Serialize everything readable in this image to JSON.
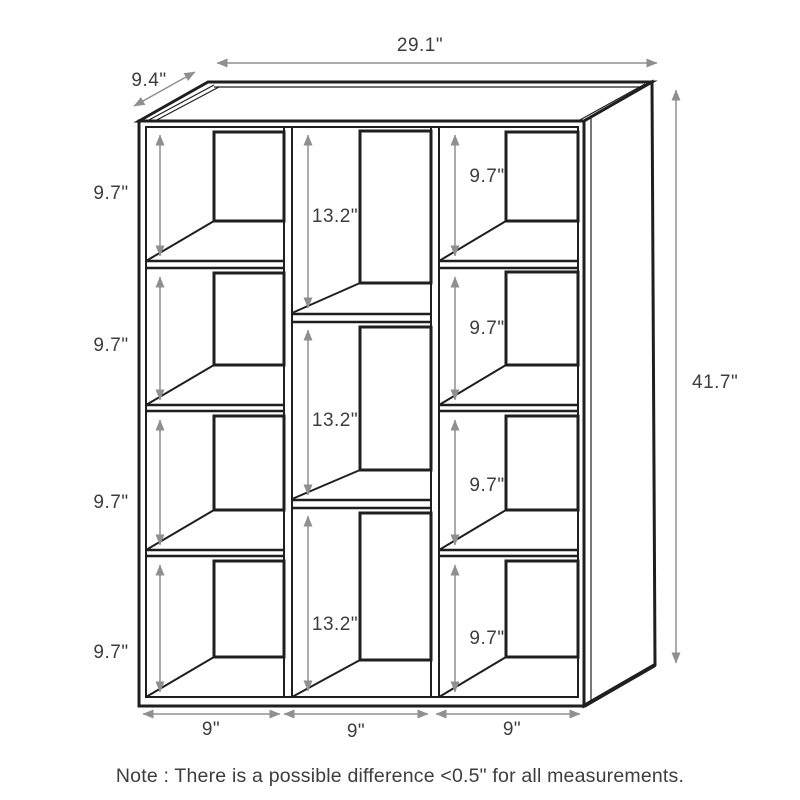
{
  "overall_dimensions": {
    "width": "29.1\"",
    "depth": "9.4\"",
    "height": "41.7\""
  },
  "left_column": {
    "cubbies": [
      "9.7\"",
      "9.7\"",
      "9.7\"",
      "9.7\""
    ],
    "bottom_width": "9\""
  },
  "middle_column": {
    "cubbies": [
      "13.2\"",
      "13.2\"",
      "13.2\""
    ],
    "bottom_width": "9\""
  },
  "right_column": {
    "cubbies": [
      "9.7\"",
      "9.7\"",
      "9.7\"",
      "9.7\""
    ],
    "bottom_width": "9\""
  },
  "note": "Note : There is a possible difference <0.5\" for all measurements.",
  "colors": {
    "line": "#1f1f1f",
    "dimension_line": "#8f8f8f",
    "label_text": "#3d3d3d",
    "background": "#ffffff"
  }
}
